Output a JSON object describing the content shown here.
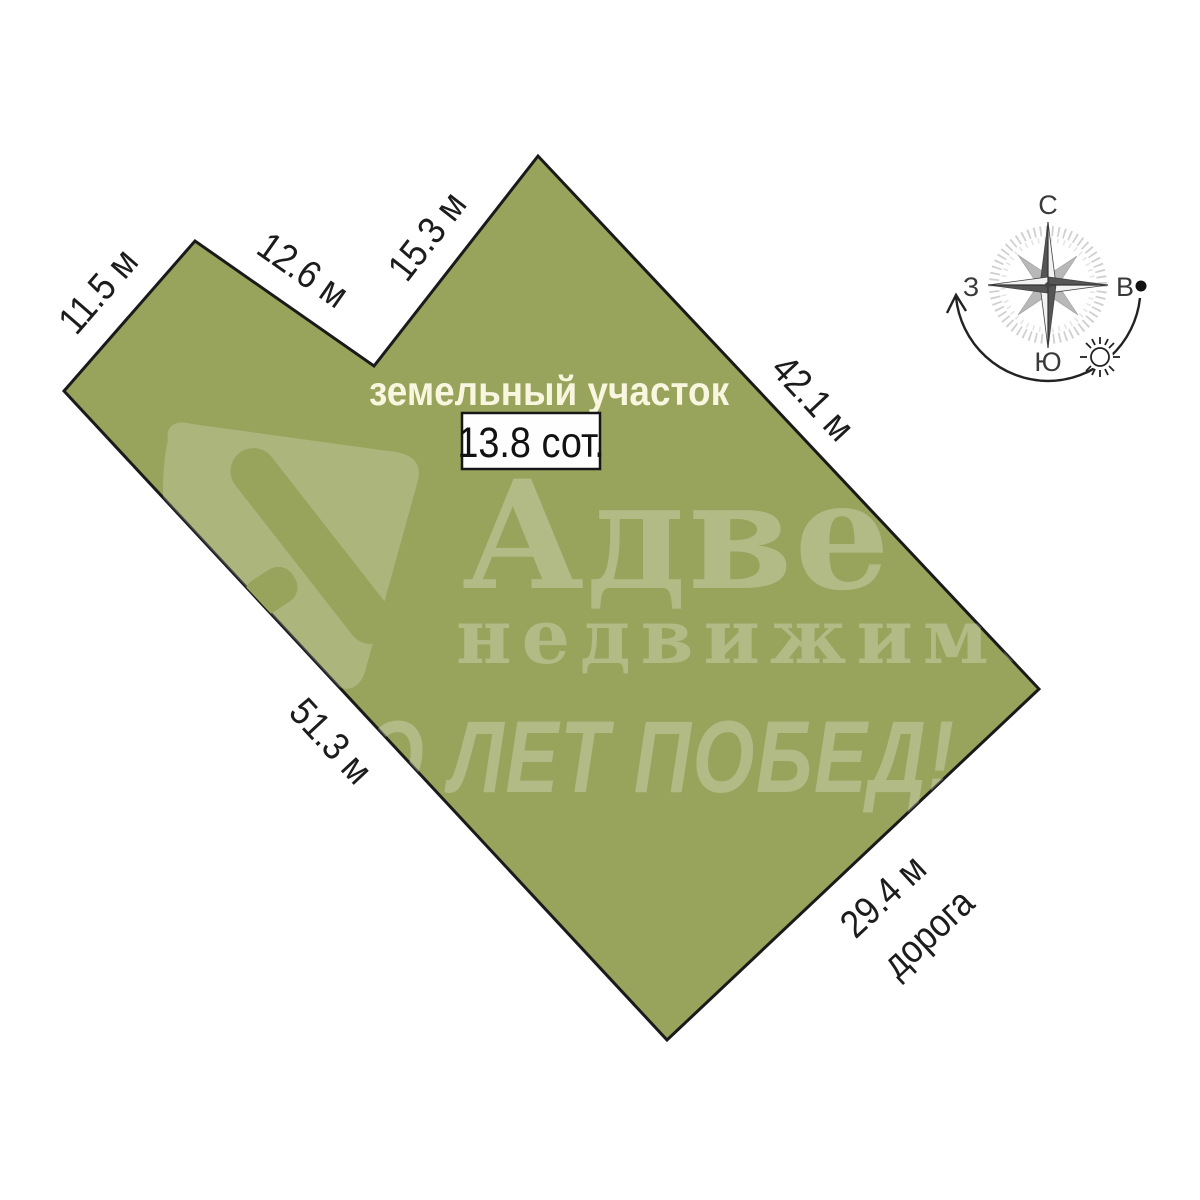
{
  "diagram": {
    "plot_label": "земельный участок",
    "area_label": "13.8 сот.",
    "road_label": "дорога",
    "dimensions": {
      "side_a": "11.5 м",
      "side_b": "12.6 м",
      "side_c": "15.3 м",
      "side_d": "42.1 м",
      "side_e": "29.4 м",
      "side_f": "51.3 м"
    },
    "colors": {
      "plot_fill": "#98a35c",
      "plot_border": "#1a1a1a",
      "plot_label_text": "#f9f6e0",
      "dimension_text": "#1c1c1c",
      "area_box_background": "#fefefe",
      "background": "#ffffff"
    }
  },
  "compass": {
    "north": "С",
    "east": "В",
    "south": "Ю",
    "west": "З"
  },
  "watermark": {
    "brand": "Адве",
    "subtitle": "недвижимос",
    "slogan": "О ЛЕТ ПОБЕД!"
  }
}
